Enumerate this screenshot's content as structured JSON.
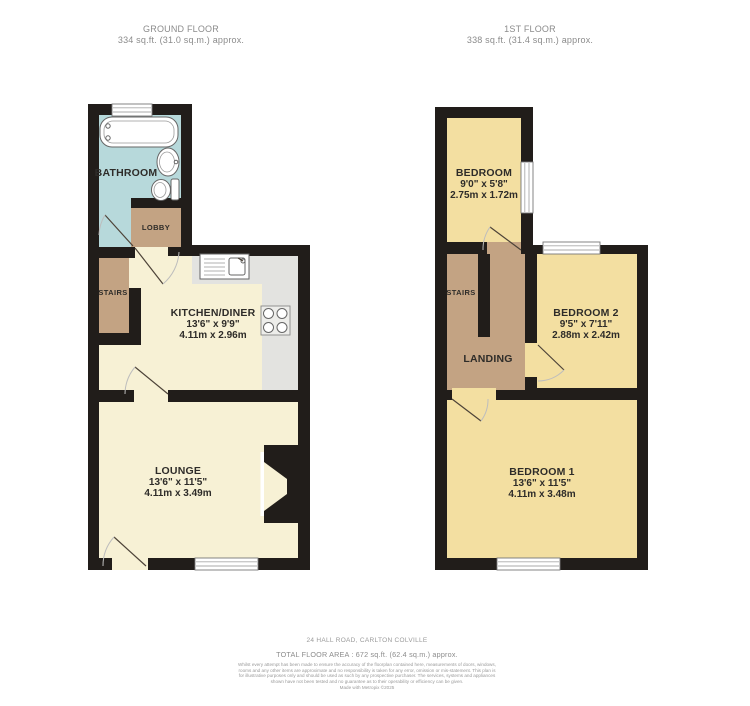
{
  "floors": [
    {
      "title": "GROUND FLOOR",
      "area_label": "334 sq.ft. (31.0 sq.m.) approx."
    },
    {
      "title": "1ST FLOOR",
      "area_label": "338 sq.ft. (31.4 sq.m.) approx."
    }
  ],
  "rooms": {
    "bathroom": {
      "name": "BATHROOM"
    },
    "lobby": {
      "name": "LOBBY"
    },
    "stairs_ground": {
      "name": "STAIRS"
    },
    "kitchen": {
      "name": "KITCHEN/DINER",
      "imperial": "13'6\" x 9'9\"",
      "metric": "4.11m x 2.96m"
    },
    "lounge": {
      "name": "LOUNGE",
      "imperial": "13'6\" x 11'5\"",
      "metric": "4.11m x 3.49m"
    },
    "bedroom": {
      "name": "BEDROOM",
      "imperial": "9'0\" x 5'8\"",
      "metric": "2.75m x 1.72m"
    },
    "stairs_first": {
      "name": "STAIRS"
    },
    "landing": {
      "name": "LANDING"
    },
    "bedroom2": {
      "name": "BEDROOM 2",
      "imperial": "9'5\" x 7'11\"",
      "metric": "2.88m x 2.42m"
    },
    "bedroom1": {
      "name": "BEDROOM 1",
      "imperial": "13'6\" x 11'5\"",
      "metric": "4.11m x 3.48m"
    }
  },
  "footer": {
    "address": "24 HALL ROAD, CARLTON COLVILLE",
    "total_area": "TOTAL FLOOR AREA : 672 sq.ft. (62.4 sq.m.) approx.",
    "disclaimer": "Whilst every attempt has been made to ensure the accuracy of the floorplan contained here, measurements of doors, windows, rooms and any other items are approximate and no responsibility is taken for any error, omission or mis-statement. This plan is for illustrative purposes only and should be used as such by any prospective purchaser. The services, systems and appliances shown have not been tested and no guarantee as to their operability or efficiency can be given.",
    "made_with": "Made with Metropix ©2025"
  },
  "colors": {
    "wall": "#211d1a",
    "ground_room": "#f7f1d5",
    "bathroom": "#b7d9db",
    "tan": "#c3a383",
    "counter": "#e3e3e0",
    "first_room": "#f3dfa1",
    "window": "#ffffff",
    "hob_body": "#ededea"
  }
}
